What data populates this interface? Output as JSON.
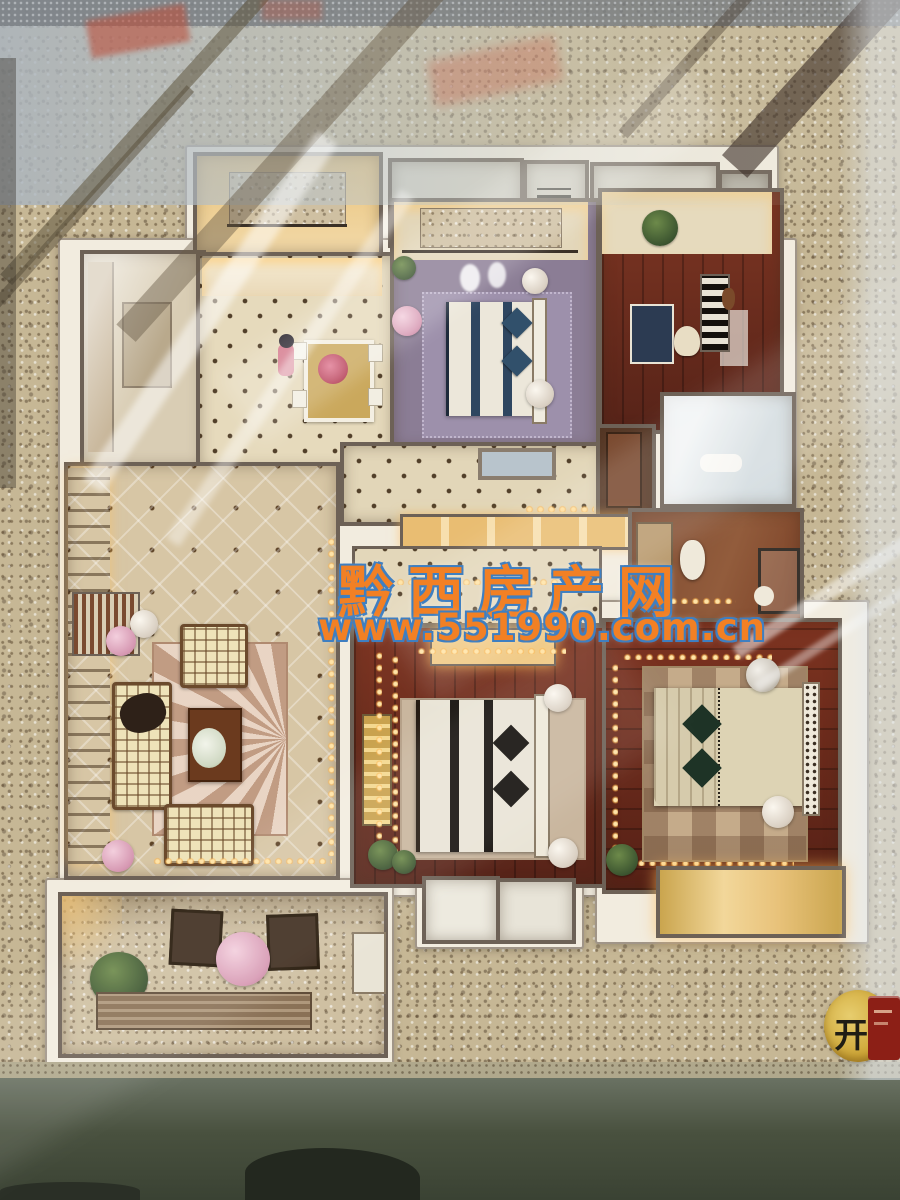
{
  "watermark": {
    "site_name": "黔西房产网",
    "site_url": "www.551990.com.cn",
    "text_color": "#f28024",
    "outline_color": "#3f7fc1"
  },
  "corner_sign": {
    "label": "开",
    "plate_color": "#cfa738",
    "tag_color": "#8c1f16"
  },
  "palette": {
    "terrazzo_floor": "#c6b795",
    "model_wall_white": "#f2ecdf",
    "wall_trim": "#6d6156",
    "dark_wood_floor": "#6f2d1f",
    "master_floor_mauve": "#8b7d95",
    "living_floor_tufted": "#d7c6a5",
    "led_string_light": "#ffcf7e",
    "glass_reflection": "#dfe7ec",
    "display_base": "#3d443a"
  }
}
